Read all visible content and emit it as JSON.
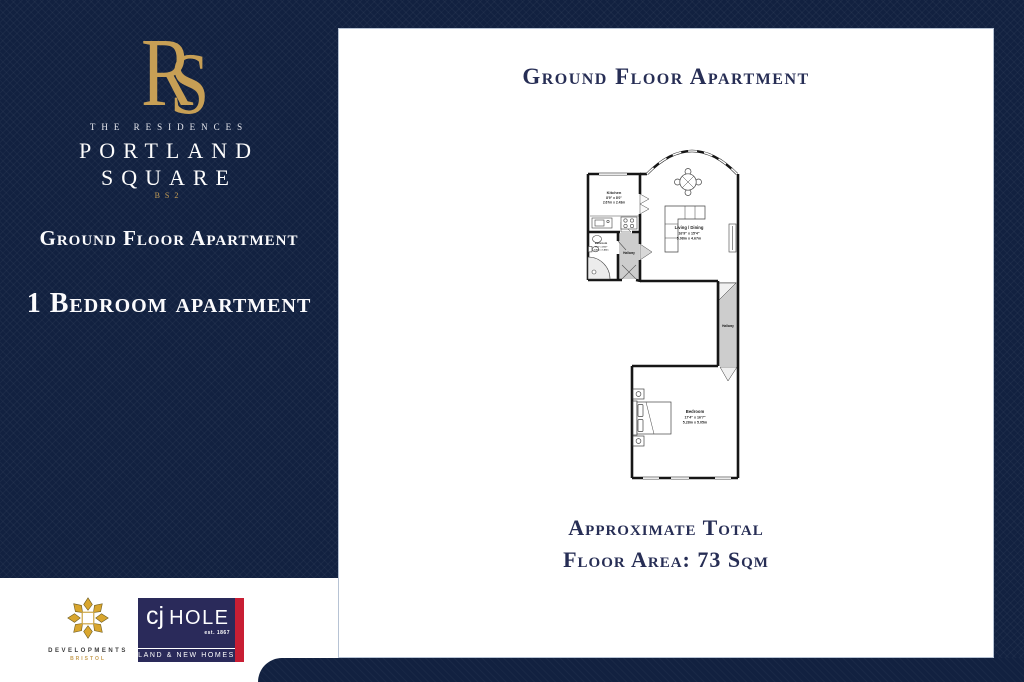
{
  "colors": {
    "navy": "#122140",
    "gold": "#c79f55",
    "cjhole_navy": "#2a2a5a",
    "cjhole_red": "#c81e34"
  },
  "brand": {
    "monogram_r": "R",
    "monogram_s": "S",
    "tagline": "THE RESIDENCES",
    "name_line1": "PORTLAND",
    "name_line2": "SQUARE",
    "postcode": "BS2"
  },
  "sidebar": {
    "floor_label": "Ground Floor Apartment",
    "type_label": "1 Bedroom apartment"
  },
  "main": {
    "title": "Ground Floor Apartment",
    "footer_line1": "Approximate Total",
    "footer_line2": "Floor Area: 73 Sqm"
  },
  "floorplan": {
    "rooms": {
      "kitchen": {
        "name": "Kitchen",
        "imperial": "8'9\" x 8'0\"",
        "metric": "2.67m x 2.43m"
      },
      "living": {
        "name": "Living / Dining",
        "imperial": "16'9\" x 15'4\"",
        "metric": "5.08m x 4.67m"
      },
      "bathroom": {
        "name": "Bathroom",
        "imperial": "7'10\" x 4'10\"",
        "metric": "2.40m x 1.48m"
      },
      "bedroom": {
        "name": "Bedroom",
        "imperial": "17'4\" x 16'7\"",
        "metric": "5.28m x 5.05m"
      },
      "hallway": {
        "name": "Hallway"
      }
    }
  },
  "footer_logos": {
    "developments": {
      "line1": "DEVELOPMENTS",
      "line2": "BRISTOL"
    },
    "cjhole": {
      "prefix": "cj",
      "name": "HOLE",
      "est": "est. 1867",
      "banner": "LAND & NEW HOMES"
    }
  }
}
